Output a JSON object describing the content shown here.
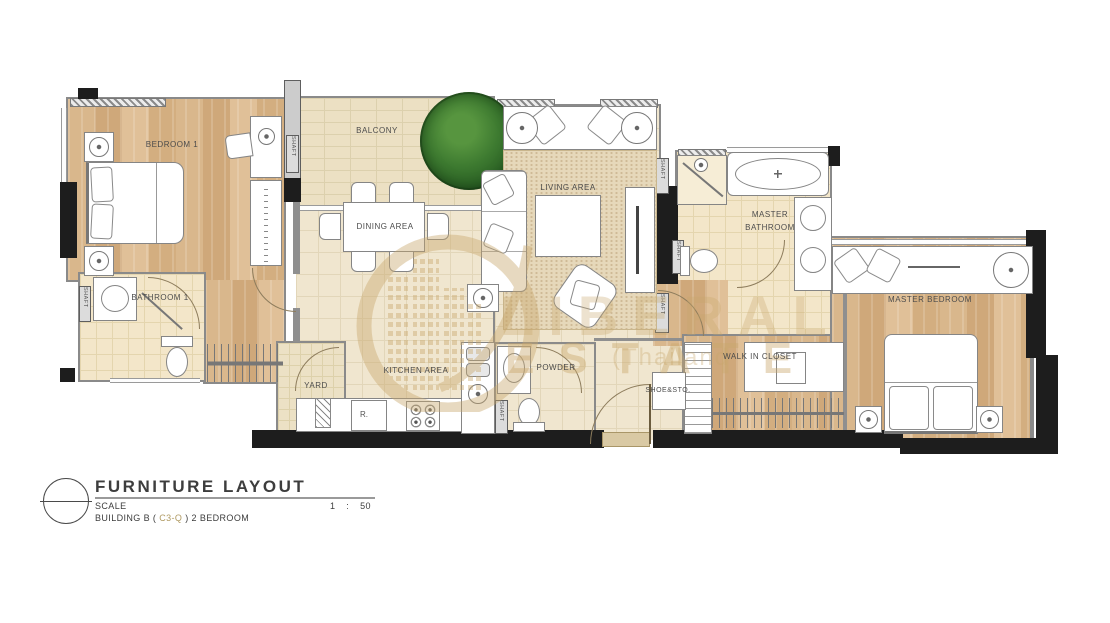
{
  "document": {
    "type": "architectural floor plan",
    "drawing_name": "FURNITURE LAYOUT"
  },
  "rooms": {
    "bedroom1": "BEDROOM 1",
    "bathroom1": "BATHROOM 1",
    "balcony": "BALCONY",
    "dining": "DINING AREA",
    "living": "LIVING AREA",
    "kitchen": "KITCHEN AREA",
    "powder": "POWDER",
    "yard": "YARD",
    "master_bathroom_l1": "MASTER",
    "master_bathroom_l2": "BATHROOM",
    "master_bedroom": "MASTER BEDROOM",
    "walk_in_closet": "WALK IN  CLOSET",
    "shoe_storage": "SHOE&STO.",
    "refrigerator": "R.",
    "shaft": "SHAFT"
  },
  "watermark": {
    "line1": "LIBERAL",
    "line2": "ESTATE",
    "line3": "(Thailand",
    "color": "#c8a76c"
  },
  "title_block": {
    "title": "FURNITURE LAYOUT",
    "scale_label": "SCALE",
    "scale_value": "1  :  50",
    "building_prefix": "BUILDING B ( ",
    "building_code": "C3-Q",
    "building_suffix": " ) 2 BEDROOM"
  },
  "colors": {
    "wood_floor": "#d6b287",
    "cream_floor": "#f0e6cf",
    "tile_floor": "#f3e6c9",
    "wall_black": "#1d1d1d",
    "wall_gray": "#8a8a8a",
    "watermark_gold": "#c8a76c",
    "tree_green": "#2e6b2a"
  }
}
